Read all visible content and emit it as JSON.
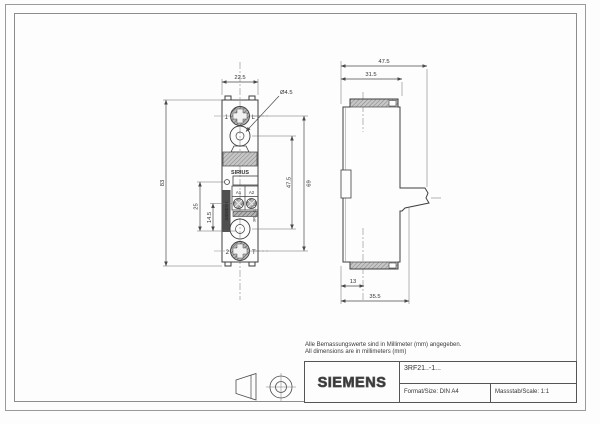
{
  "front_view": {
    "dim_width": "22.5",
    "dim_hole": "Ø4.5",
    "dim_height": "83",
    "dim_offset_25": "25",
    "dim_offset_14_5": "14.5",
    "dim_hole_spacing": "47.5",
    "dim_screw_spacing": "69",
    "label_terminal1": "1",
    "label_terminal1_type": "L",
    "label_terminal2": "2",
    "label_terminal2_type": "T",
    "label_product": "SIRIUS",
    "label_a1": "A1",
    "label_a2": "A2",
    "label_brand_vertical": "SIEMENS",
    "label_model_vertical": "3RF21..-1..."
  },
  "side_view": {
    "dim_depth_total": "47.5",
    "dim_depth_body": "31.5",
    "dim_foot": "13",
    "dim_depth_base": "35.5"
  },
  "notes": {
    "line1": "Alle Bemassungswerte sind in Millimeter (mm) angegeben.",
    "line2": "All dimensions are in millimeters (mm)"
  },
  "title_block": {
    "brand": "SIEMENS",
    "model": "3RF21..-1...",
    "format": "Format/Size: DIN A4",
    "scale": "Massstab/Scale: 1:1"
  },
  "colors": {
    "line": "#3f3f3f",
    "dim_line": "#555555",
    "frame": "#9a9a9a",
    "hatch_fill": "#b9b9b9"
  }
}
